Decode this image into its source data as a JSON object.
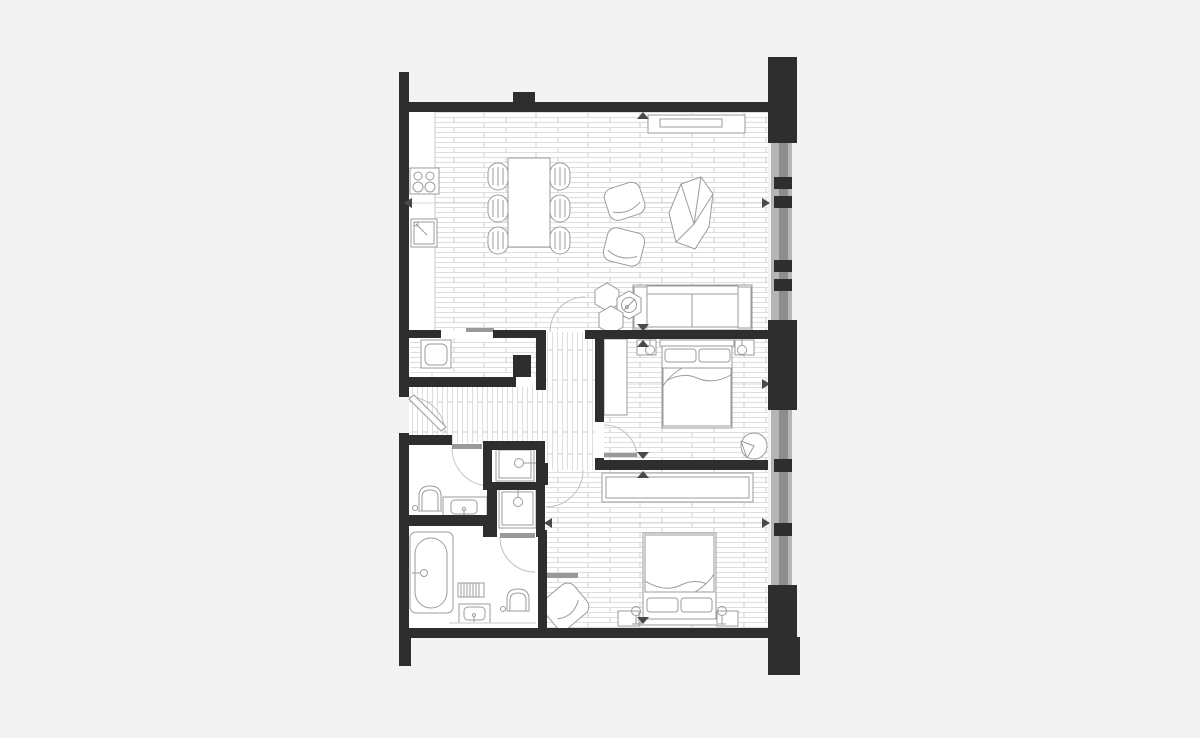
{
  "canvas": {
    "width": 1200,
    "height": 733,
    "background": "#f3f3f4"
  },
  "drawing": {
    "kind": "apartment-floor-plan",
    "visible_text": [],
    "colors": {
      "background": "#f3f3f4",
      "room_fill": "#ffffff",
      "wall": "#2e2e2e",
      "window_frame_light": "#b5b5b5",
      "window_glass": "#8d8d8d",
      "floor_line": "#dedede",
      "floor_joint": "#cdcdcd",
      "furniture_stroke": "#9b9b9b",
      "furniture_fill": "#ffffff",
      "door_leaf": "#999999",
      "swing_arc": "#c0c0c0",
      "marker": "#4a4a4a",
      "dimension": "#cfcfcf",
      "counter_edge": "#c9c9c9"
    },
    "rooms": [
      {
        "name": "living-dining-kitchen",
        "floor": "plank-horizontal",
        "features": [
          "hob-4-ring",
          "kitchen-sink",
          "dining-table",
          "dining-chairs-x6",
          "swivel-armchair-x2",
          "lounge-chair",
          "sofa-3-seat",
          "hex-side-tables-x3",
          "table-lamp",
          "sideboard"
        ]
      },
      {
        "name": "hallway",
        "floor": "plank-vertical",
        "features": [
          "entrance-door",
          "utility-closet",
          "washing-machine",
          "service-duct"
        ]
      },
      {
        "name": "bedroom-1",
        "floor": "plank-horizontal",
        "features": [
          "double-bed",
          "pillow-x2",
          "bedside-table-x2",
          "bedside-lamp-x2",
          "wardrobe",
          "round-side-table"
        ]
      },
      {
        "name": "bedroom-2",
        "floor": "plank-horizontal",
        "features": [
          "double-bed",
          "pillow-x2",
          "bedside-table-x2",
          "bedside-lamp-x2",
          "wardrobe-run",
          "armchair"
        ]
      },
      {
        "name": "shower-room-1",
        "floor": "plain",
        "features": [
          "shower-tray",
          "shower-head"
        ]
      },
      {
        "name": "shower-room-2",
        "floor": "plain",
        "features": [
          "shower-tray",
          "shower-head"
        ]
      },
      {
        "name": "ensuite-bathroom",
        "floor": "plain",
        "features": [
          "toilet",
          "vanity-basin"
        ]
      },
      {
        "name": "bathroom",
        "floor": "plain",
        "features": [
          "bathtub",
          "towel-radiator",
          "vanity-basin",
          "toilet"
        ]
      }
    ],
    "windows": {
      "side": "right",
      "bands": 2,
      "mullion_blocks": 4
    },
    "markers": {
      "wall_triangles": 6,
      "dimension_arrows": 6,
      "dimension_lines": 3,
      "door_swing_arcs": 6
    }
  }
}
